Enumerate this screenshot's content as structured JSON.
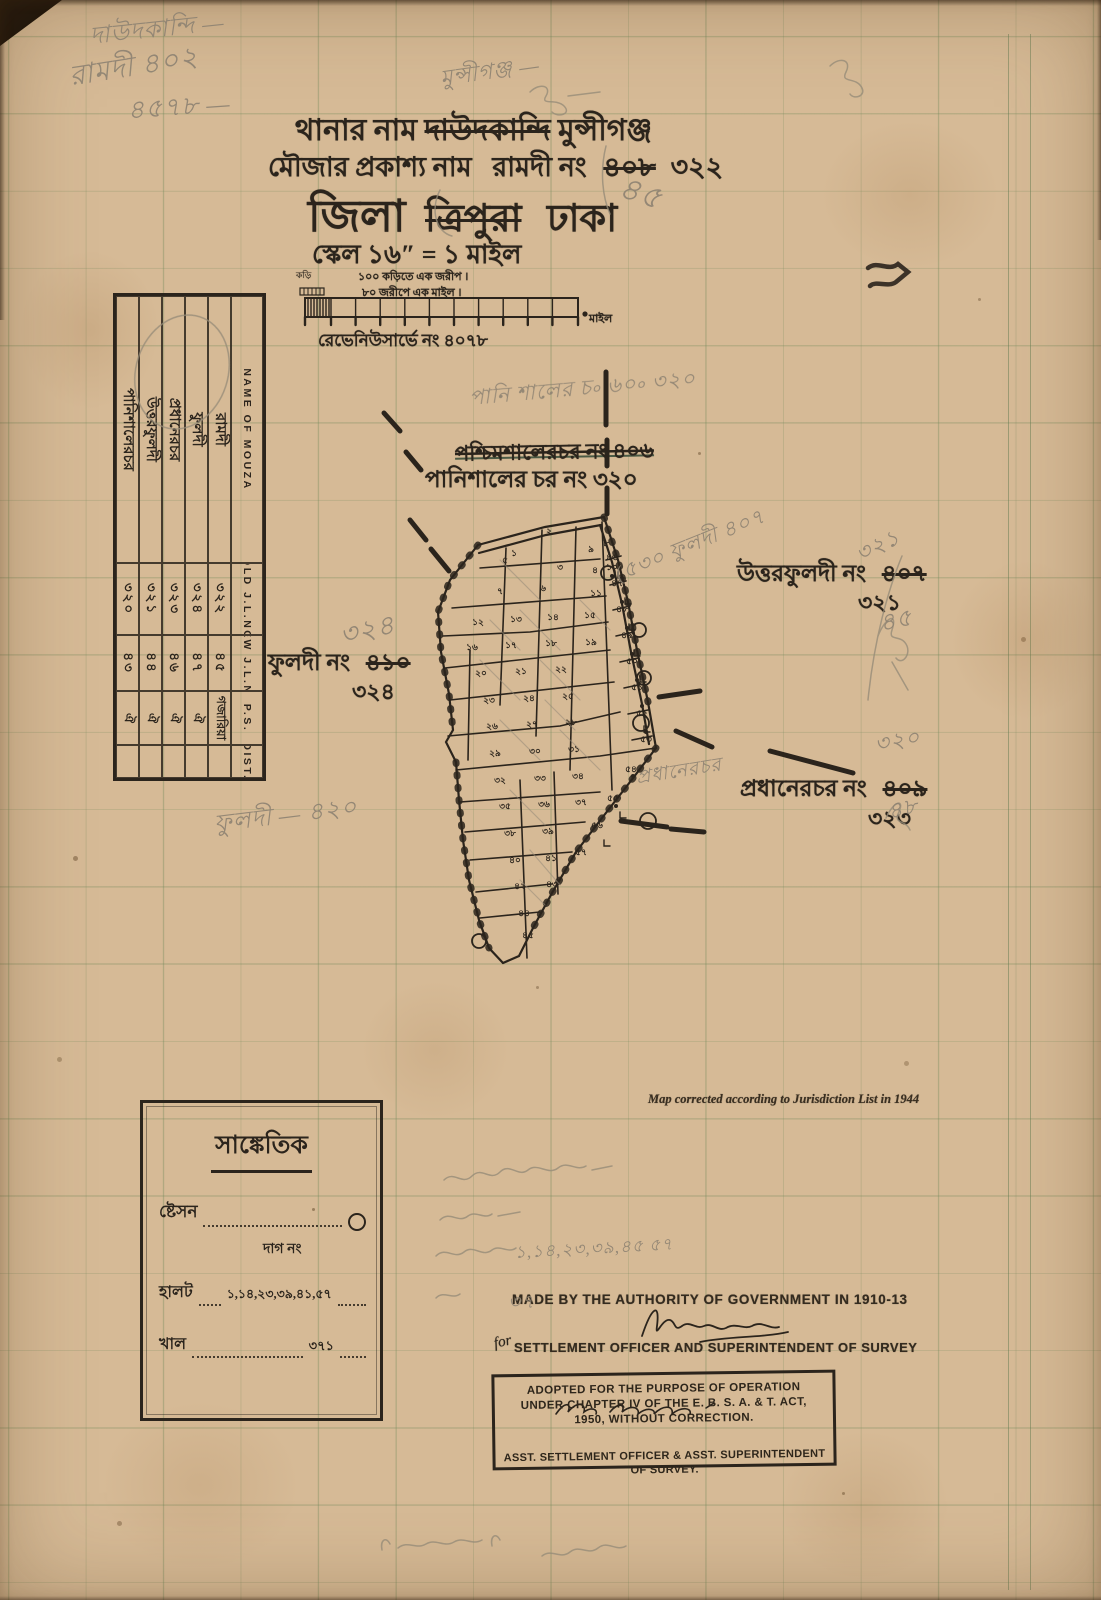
{
  "header": {
    "line1_label": "থানার নাম",
    "line1_struck": "দাউদকান্দি",
    "line1_value": "মুন্সীগঞ্জ",
    "line2_label": "মৌজার প্রকাশ্য নাম",
    "line2_value": "রামদী নং",
    "line2_struck": "৪০৮",
    "line2_new": "৩২২",
    "line3_label": "জিলা",
    "line3_struck": "ত্রিপুরা",
    "line3_value": "ঢাকা",
    "scale_line": "স্কেল ১৬″ = ১ মাইল",
    "scale_note1": "১০০ কড়িতে এক জরীপ ।",
    "scale_note2": "৮০ জরীপে এক মাইল ।",
    "scale_left_small": "কড়ি",
    "scale_right_label": "মাইল",
    "survey_no": "রেভেনিউসার্ভে নং ৪০৭৮"
  },
  "mouza_table": {
    "headers": [
      "NAME OF MOUZA",
      "OLD J.L.NO",
      "NEW J.L.NO",
      "P.S.",
      "DIST."
    ],
    "rows": [
      {
        "name": "রামদী",
        "old": "৩২২",
        "new": "৪৫",
        "ps": "গজারিয়া",
        "dist": ""
      },
      {
        "name": "ফুলদী",
        "old": "৩২৪",
        "new": "৪৭",
        "ps": "ঐ",
        "dist": ""
      },
      {
        "name": "প্রধানেরচর",
        "old": "৩২৩",
        "new": "৪৬",
        "ps": "ঐ",
        "dist": ""
      },
      {
        "name": "উত্তরফুলদী",
        "old": "৩২১",
        "new": "৪৪",
        "ps": "ঐ",
        "dist": ""
      },
      {
        "name": "পানিশালেরচর",
        "old": "৩২০",
        "new": "৪৩",
        "ps": "ঐ",
        "dist": ""
      }
    ]
  },
  "map": {
    "label_north_struck": "পশ্চিমশালেরচর নং ৪০৬",
    "label_north": "পানিশালের চর নং ৩২০",
    "label_east": "উত্তরফুলদী নং",
    "label_east_struck": "৪০৭",
    "label_east_new": "৩২১",
    "label_west": "ফুলদী নং",
    "label_west_struck": "৪১০",
    "label_west_new": "৩২৪",
    "label_southeast": "প্রধানেরচর নং",
    "label_southeast_struck": "৪০৯",
    "label_southeast_new": "৩২৩",
    "parcels": [
      {
        "n": "২",
        "x": 549,
        "y": 534
      },
      {
        "n": "১",
        "x": 514,
        "y": 556
      },
      {
        "n": "৩",
        "x": 560,
        "y": 570
      },
      {
        "n": "৯",
        "x": 591,
        "y": 552
      },
      {
        "n": "৪",
        "x": 595,
        "y": 573
      },
      {
        "n": "৫",
        "x": 505,
        "y": 563
      },
      {
        "n": "৬",
        "x": 543,
        "y": 591
      },
      {
        "n": "৭",
        "x": 500,
        "y": 594
      },
      {
        "n": "৮",
        "x": 606,
        "y": 546
      },
      {
        "n": "১০",
        "x": 612,
        "y": 570
      },
      {
        "n": "১১",
        "x": 596,
        "y": 596
      },
      {
        "n": "১২",
        "x": 478,
        "y": 625
      },
      {
        "n": "১৩",
        "x": 516,
        "y": 622
      },
      {
        "n": "১৪",
        "x": 553,
        "y": 620
      },
      {
        "n": "১৫",
        "x": 590,
        "y": 618
      },
      {
        "n": "১৬",
        "x": 472,
        "y": 650
      },
      {
        "n": "১৭",
        "x": 511,
        "y": 648
      },
      {
        "n": "১৮",
        "x": 551,
        "y": 646
      },
      {
        "n": "১৯",
        "x": 591,
        "y": 645
      },
      {
        "n": "২০",
        "x": 481,
        "y": 676
      },
      {
        "n": "২১",
        "x": 521,
        "y": 674
      },
      {
        "n": "২২",
        "x": 561,
        "y": 672
      },
      {
        "n": "২৩",
        "x": 489,
        "y": 703
      },
      {
        "n": "২৪",
        "x": 529,
        "y": 701
      },
      {
        "n": "২৫",
        "x": 568,
        "y": 699
      },
      {
        "n": "২৬",
        "x": 492,
        "y": 729
      },
      {
        "n": "২৭",
        "x": 532,
        "y": 727
      },
      {
        "n": "২৮",
        "x": 571,
        "y": 725
      },
      {
        "n": "২৯",
        "x": 495,
        "y": 756
      },
      {
        "n": "৩০",
        "x": 535,
        "y": 754
      },
      {
        "n": "৩১",
        "x": 574,
        "y": 752
      },
      {
        "n": "৩২",
        "x": 500,
        "y": 783
      },
      {
        "n": "৩৩",
        "x": 540,
        "y": 781
      },
      {
        "n": "৩৪",
        "x": 578,
        "y": 779
      },
      {
        "n": "৩৫",
        "x": 505,
        "y": 809
      },
      {
        "n": "৩৬",
        "x": 544,
        "y": 807
      },
      {
        "n": "৩৭",
        "x": 581,
        "y": 805
      },
      {
        "n": "৩৮",
        "x": 510,
        "y": 836
      },
      {
        "n": "৩৯",
        "x": 548,
        "y": 834
      },
      {
        "n": "৪০",
        "x": 515,
        "y": 863
      },
      {
        "n": "৪১",
        "x": 551,
        "y": 861
      },
      {
        "n": "৪২",
        "x": 520,
        "y": 889
      },
      {
        "n": "৪৩",
        "x": 552,
        "y": 887
      },
      {
        "n": "৪৪",
        "x": 524,
        "y": 916
      },
      {
        "n": "৪৫",
        "x": 528,
        "y": 938
      },
      {
        "n": "৪৬",
        "x": 612,
        "y": 560
      },
      {
        "n": "৪৭",
        "x": 617,
        "y": 586
      },
      {
        "n": "৪৮",
        "x": 622,
        "y": 612
      },
      {
        "n": "৪৯",
        "x": 627,
        "y": 638
      },
      {
        "n": "৫০",
        "x": 632,
        "y": 664
      },
      {
        "n": "৫১",
        "x": 637,
        "y": 690
      },
      {
        "n": "৫২",
        "x": 642,
        "y": 716
      },
      {
        "n": "৫৩",
        "x": 646,
        "y": 742
      },
      {
        "n": "৫৪",
        "x": 631,
        "y": 772
      },
      {
        "n": "৫৫",
        "x": 613,
        "y": 801
      },
      {
        "n": "৫৬",
        "x": 597,
        "y": 828
      },
      {
        "n": "৫৭",
        "x": 581,
        "y": 855
      }
    ]
  },
  "legend": {
    "title": "সাঙ্কেতিক",
    "item1_label": "ষ্টেসন",
    "item2_label": "দাগ নং",
    "item3_label": "হালট",
    "item3_value": "১,১৪,২৩,৩৯,৪১,৫৭",
    "item4_label": "খাল",
    "item4_value": "৩৭১"
  },
  "footer": {
    "corrected_note": "Map corrected according to Jurisdiction List in 1944",
    "authority_line": "MADE BY THE AUTHORITY OF GOVERNMENT IN 1910-13",
    "officer_pre": "for",
    "officer_line": "SETTLEMENT OFFICER AND SUPERINTENDENT OF SURVEY",
    "stamp_line1": "ADOPTED FOR THE PURPOSE OF OPERATION",
    "stamp_line2": "UNDER CHAPTER IV OF THE E. B. S. A. & T. ACT,",
    "stamp_line3": "1950, WITHOUT CORRECTION.",
    "stamp_line4": "ASST. SETTLEMENT OFFICER & ASST. SUPERINTENDENT",
    "stamp_line5": "OF SURVEY."
  },
  "handwriting": {
    "notes": [
      {
        "text": "দাউদকান্দি —",
        "x": 88,
        "y": 18,
        "size": 24,
        "rot": -6
      },
      {
        "text": "রামদী  ৪০২",
        "x": 66,
        "y": 55,
        "size": 28,
        "rot": -9
      },
      {
        "text": "৪৫৭৮ —",
        "x": 126,
        "y": 90,
        "size": 26,
        "rot": -4
      },
      {
        "text": "মুন্সীগঞ্জ —",
        "x": 438,
        "y": 62,
        "size": 22,
        "rot": -8
      },
      {
        "text": "৪৫",
        "x": 628,
        "y": 162,
        "size": 32,
        "rot": 18
      },
      {
        "text": "পানি শালের চ৹ ৬০৹  ৩২০",
        "x": 468,
        "y": 382,
        "size": 21,
        "rot": -5
      },
      {
        "text": "(৫৩০ ফুলদী ৪০৭",
        "x": 610,
        "y": 560,
        "size": 21,
        "rot": -22
      },
      {
        "text": "৩২১",
        "x": 850,
        "y": 540,
        "size": 22,
        "rot": -25
      },
      {
        "text": "৪৫",
        "x": 876,
        "y": 606,
        "size": 24,
        "rot": -12
      },
      {
        "text": "৩২৪",
        "x": 336,
        "y": 616,
        "size": 27,
        "rot": -12
      },
      {
        "text": "ফুলদী — ৪২০",
        "x": 212,
        "y": 806,
        "size": 24,
        "rot": -7
      },
      {
        "text": "প্রধানেরচর",
        "x": 634,
        "y": 764,
        "size": 19,
        "rot": -9
      },
      {
        "text": "৩২০",
        "x": 872,
        "y": 728,
        "size": 22,
        "rot": -10
      },
      {
        "text": "৪৮",
        "x": 884,
        "y": 796,
        "size": 22,
        "rot": -14
      },
      {
        "text": "১,১৪,২৩,৩৯,৪৫ ৫৭",
        "x": 514,
        "y": 1240,
        "size": 17,
        "rot": -3
      },
      {
        "text": "৩৭",
        "x": 508,
        "y": 1288,
        "size": 19,
        "rot": 0
      }
    ]
  },
  "colors": {
    "paper": "#d6ba96",
    "ink": "#2b241c",
    "pencil": "#8d8272",
    "grid": "#74905c"
  }
}
